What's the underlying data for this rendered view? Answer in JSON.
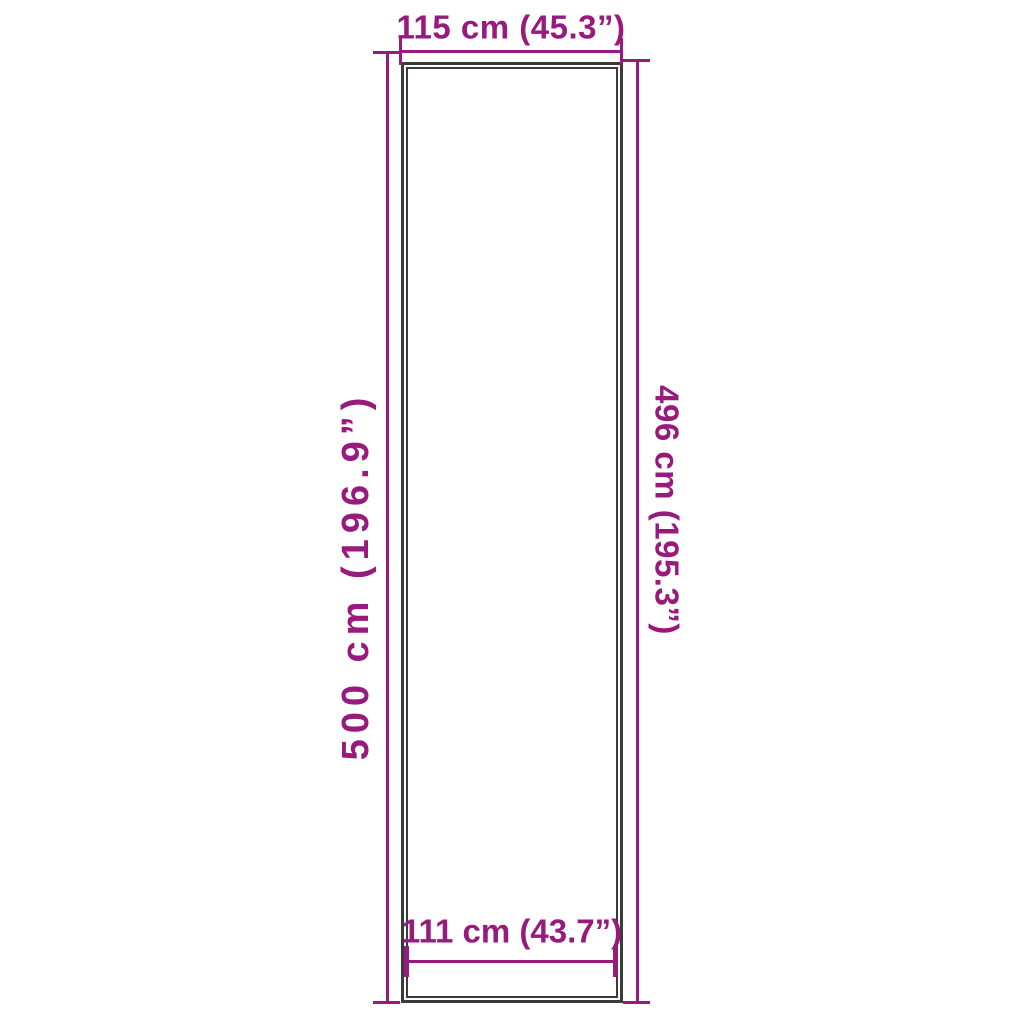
{
  "diagram": {
    "kind": "product-dimension-drawing",
    "colors": {
      "dimension": "#981a7c",
      "outline": "#3b3b3a",
      "background": "#ffffff"
    },
    "measurements": {
      "top_width": "115 cm (45.3”)",
      "left_height": "500 cm (196.9”)",
      "right_height": "496 cm (195.3”)",
      "bottom_inner_width": "111 cm (43.7”)"
    }
  }
}
